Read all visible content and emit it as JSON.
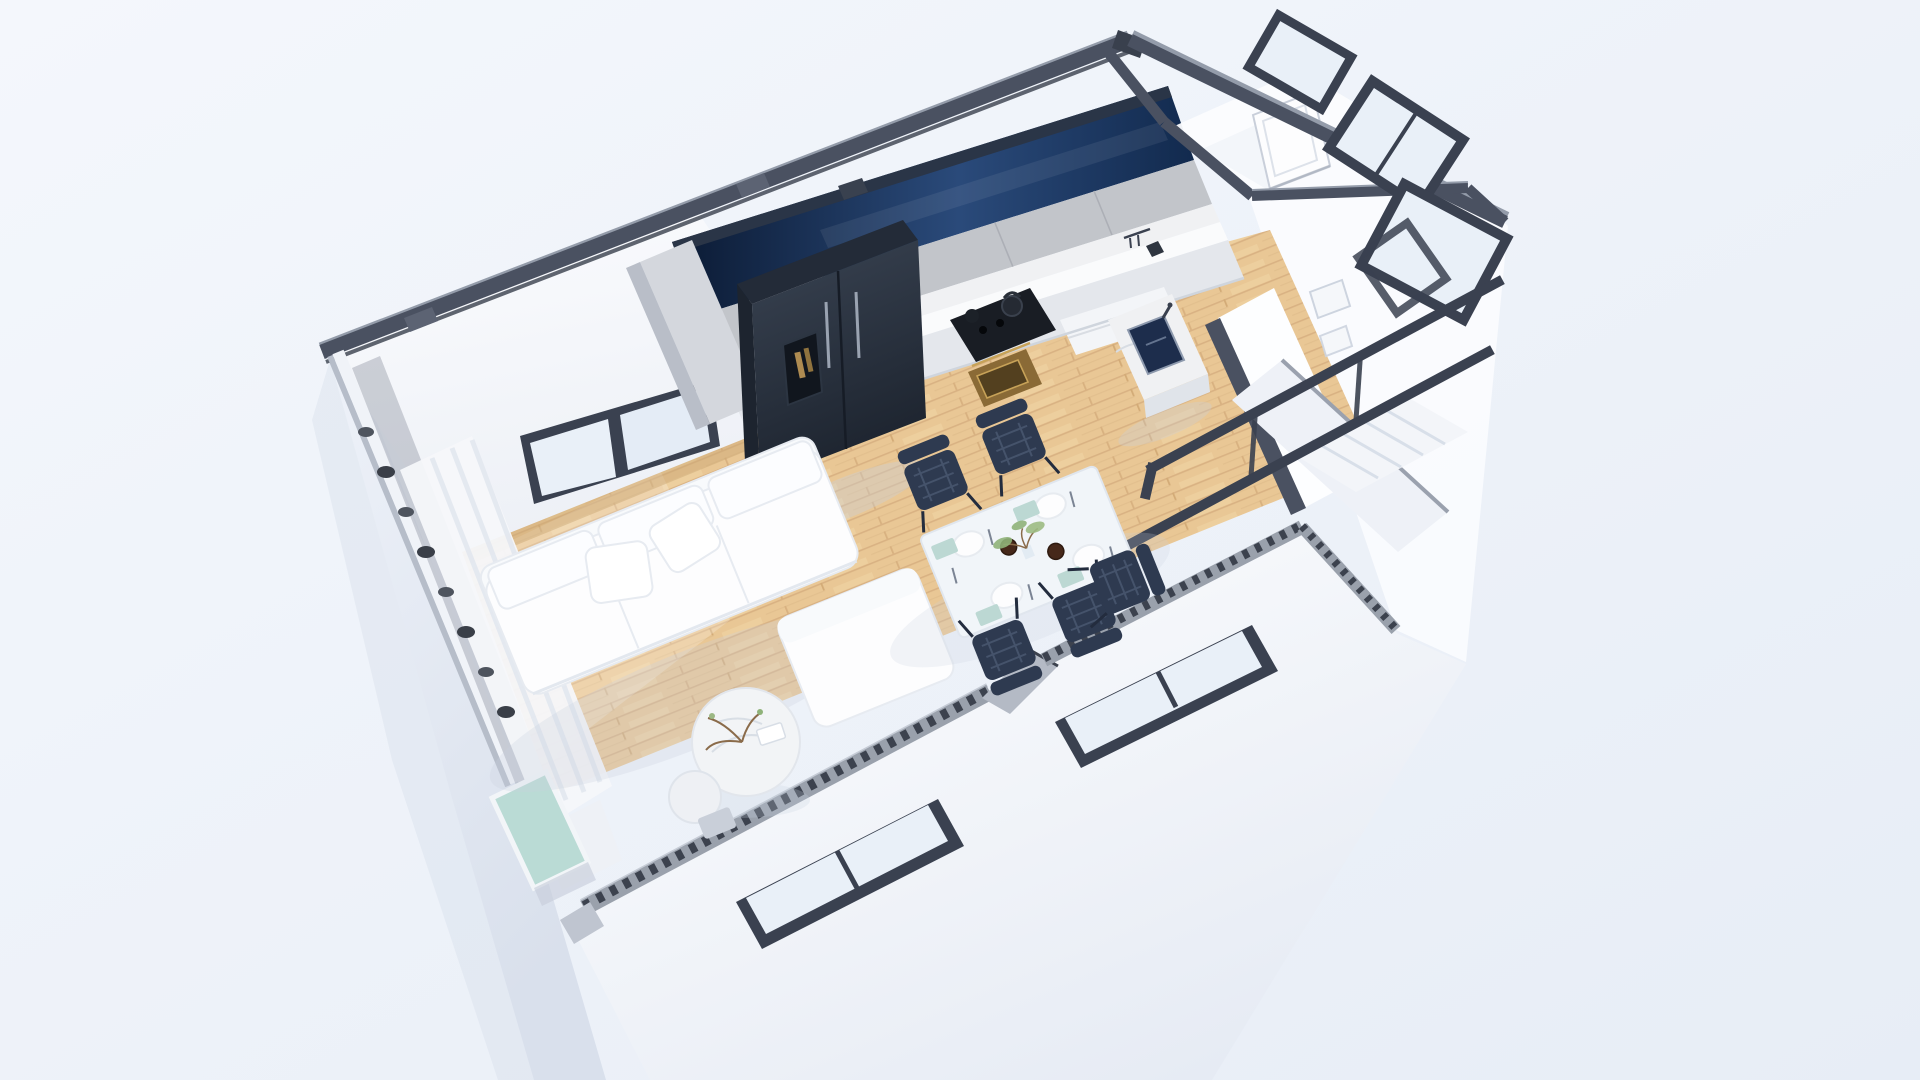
{
  "meta": {
    "description": "Photorealistic 3D isometric cutaway (dollhouse view) floor-plan render of a small apartment on a pale blue background",
    "view": "aerial oblique, long axis rotated about -22 degrees"
  },
  "scene": {
    "background": {
      "top_left": "#f4f7fc",
      "bottom_right": "#e7edf6"
    },
    "colors": {
      "wall_white": "#fbfcfe",
      "wall_shade": "#edf0f6",
      "band_dark": "#4a5161",
      "band_darker": "#39404d",
      "band_light": "#949caa",
      "glass_navy_dark": "#0b1a33",
      "glass_navy_mid": "#2a4a7a",
      "glass_navy_deep": "#122a4e",
      "window_frame": "#3a4150",
      "window_glass": "#e9f0f8",
      "floor_wood": "#e9c795",
      "floor_plank_line": "#d9b283",
      "cabinet_gray": "#c2c5ca",
      "cabinet_tall": "#d4d7dd",
      "counter_white": "#fafbfc",
      "marble": "#f0f1f3",
      "base_cabinet": "#e4e7ec",
      "fridge_top": "#232b38",
      "fridge_front": "#333c4b",
      "fridge_side": "#1d242f",
      "cooktop_black": "#191d24",
      "oven_brass": "#8a6a36",
      "oven_brass_light": "#c7a258",
      "sink_navy": "#1d2d4c",
      "sofa_white": "#fdfdfe",
      "cushion_edge": "#e7ebf1",
      "table_top": "#f1f5f9",
      "chair_navy": "#2e3a50",
      "chair_mesh": "#4a5870",
      "napkin_teal": "#bcd8d3",
      "bowl_brown": "#46281a",
      "plant_green": "#8fb279",
      "plant_stem": "#8a6b4a",
      "stair_white": "#f3f5f9",
      "rail_dark": "#3a4150",
      "curtain_white": "#f5f7fa",
      "balcony_plant_dark": "#4e545e",
      "balcony_glass_teal": "#badbd5",
      "facade_white": "#ffffff",
      "facade_shade": "#e6ebf4",
      "exterior_left_light": "#eef2f9",
      "exterior_left_shade": "#d9e0ec",
      "cut_edge_base": "#9aa1ac",
      "cut_edge_teeth": "#3c424e",
      "soft_shadow": "#c9d2df"
    },
    "rooms": [
      {
        "name": "living-room",
        "contents": [
          "l-shaped-sofa",
          "back-cushions",
          "throw-pillows",
          "round-coffee-table",
          "round-side-table",
          "window"
        ]
      },
      {
        "name": "kitchen",
        "contents": [
          "navy-glass-window-band",
          "upper-cabinets",
          "marble-backsplash",
          "counter",
          "base-cabinets",
          "refrigerator",
          "cooktop",
          "kettle",
          "oven",
          "sink-island"
        ]
      },
      {
        "name": "dining-area",
        "contents": [
          "white-dining-table",
          "mesh-chairs",
          "plates",
          "teal-napkins",
          "brown-bowls",
          "plant-centerpiece"
        ]
      },
      {
        "name": "hallway",
        "contents": [
          "partition-walls",
          "wood-floor"
        ]
      },
      {
        "name": "bathroom",
        "contents": [
          "leaning-door",
          "white-walls"
        ]
      },
      {
        "name": "staircase",
        "contents": [
          "white-steps",
          "dark-handrails"
        ]
      },
      {
        "name": "balcony",
        "contents": [
          "sheer-curtain",
          "planter-row",
          "teal-glass-balustrade",
          "sliding-door"
        ]
      },
      {
        "name": "exterior",
        "contents": [
          "front-facade",
          "facade-window-a",
          "facade-window-b",
          "tilted-right-windows",
          "sawtooth-cut-wall-edge"
        ]
      }
    ],
    "counts": {
      "dining_chairs_visible": 5,
      "back_wall_window_panes": 2,
      "facade_windows": 2,
      "right_wall_windows": 3,
      "stair_steps_visible": 5
    }
  }
}
